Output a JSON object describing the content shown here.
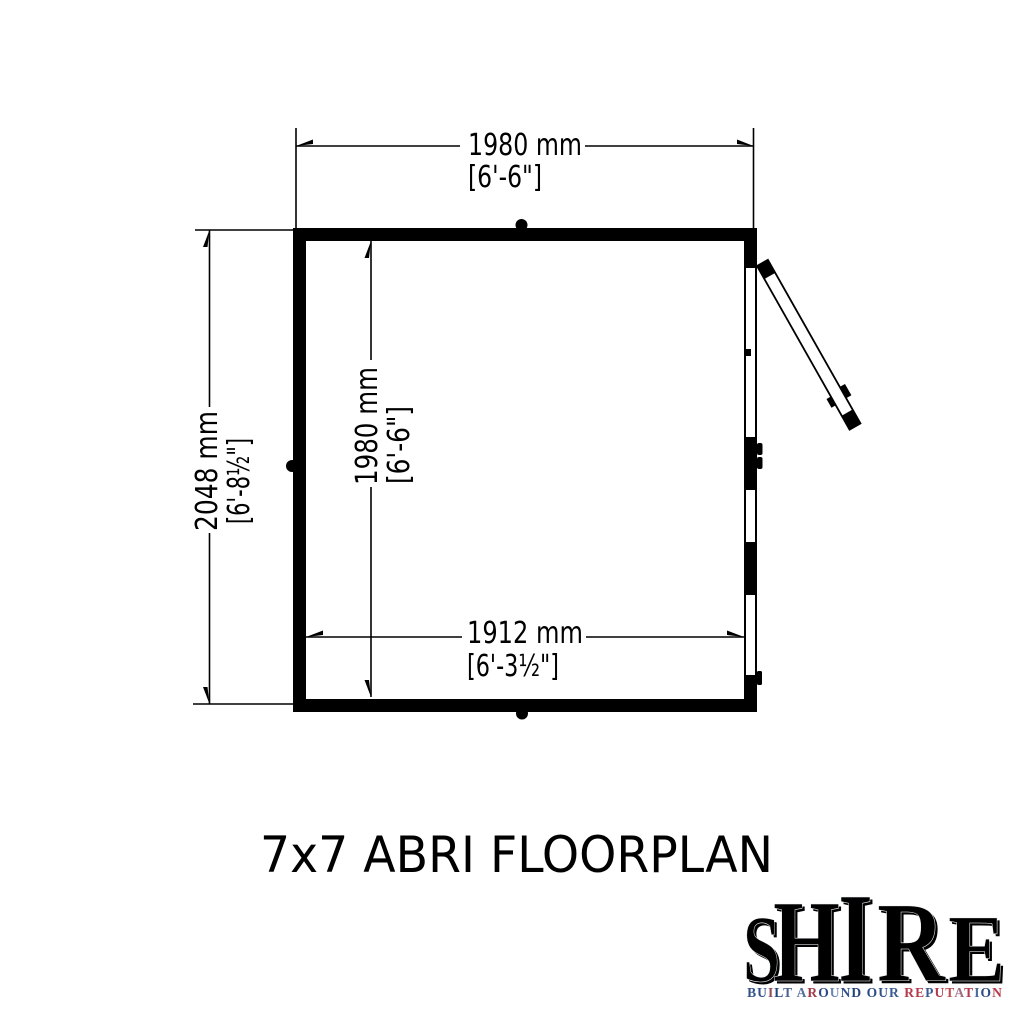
{
  "title": "7x7 ABRI FLOORPLAN",
  "colors": {
    "ink": "#000000",
    "background": "#ffffff",
    "flag_navy": "#1d3a7a",
    "flag_blue": "#27498c",
    "flag_red": "#c9303e",
    "flag_red_bright": "#d8452f",
    "flag_white": "#e8ecf3",
    "letter_shadow": "#c7cdd8",
    "letter_bevel": "#eef1f6"
  },
  "dimensions": {
    "top": {
      "metric": "1980 mm",
      "imperial": "[6'-6\"]"
    },
    "left": {
      "metric": "2048 mm",
      "imperial": "[6'-8½\"]"
    },
    "inner_height": {
      "metric": "1980 mm",
      "imperial": "[6'-6\"]"
    },
    "inner_width": {
      "metric": "1912 mm",
      "imperial": "[6'-3½\"]"
    }
  },
  "logo": {
    "brand": "SHIRE",
    "brand_letters": [
      {
        "ch": "S"
      },
      {
        "ch": "H"
      },
      {
        "ch": "I"
      },
      {
        "ch": "R"
      },
      {
        "ch": "E"
      }
    ],
    "tagline": "BUILT AROUND OUR REPUTATION",
    "tagline_colors": [
      "#30518a",
      "#30518a",
      "#8f4a5c",
      "#24427c",
      "#4a6394",
      "#000000",
      "#54709f",
      "#a03a4a",
      "#2b4a84",
      "#6d87b0",
      "#30518a",
      "#24427c",
      "#000000",
      "#2b4a84",
      "#30518a",
      "#3a5a93",
      "#000000",
      "#b5394a",
      "#b5394a",
      "#3a5a93",
      "#b5394a",
      "#c04a50",
      "#a07080",
      "#b5394a",
      "#4a6a9a",
      "#2b4a84",
      "#b5394a"
    ]
  }
}
